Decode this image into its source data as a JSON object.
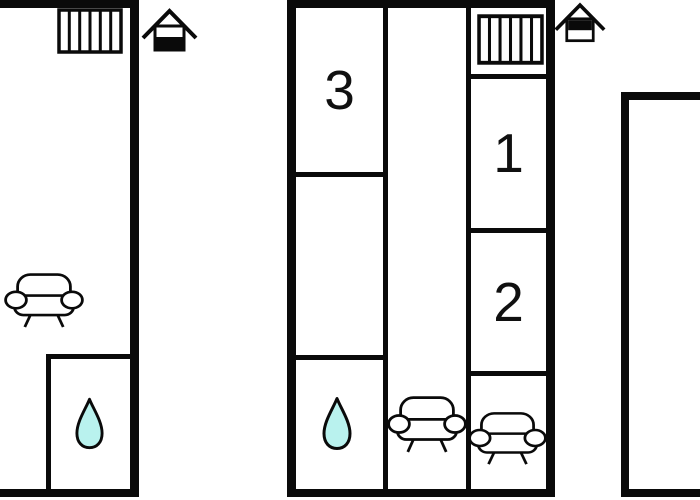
{
  "figure": {
    "type": "floor-plan",
    "description": "black-and-white apartment floor plans, three units side by side"
  },
  "colors": {
    "wall": "#0a0a0a",
    "background": "#ffffff",
    "water_drop": "#b9f2ee"
  },
  "icons": {
    "radiator": "radiator-icon",
    "house": "house-entrance-icon",
    "sofa": "sofa-icon",
    "water_drop": "water-drop-icon"
  },
  "plans": {
    "middle": {
      "rooms": [
        {
          "label": "3"
        },
        {
          "label": "1"
        },
        {
          "label": "2"
        }
      ]
    }
  }
}
